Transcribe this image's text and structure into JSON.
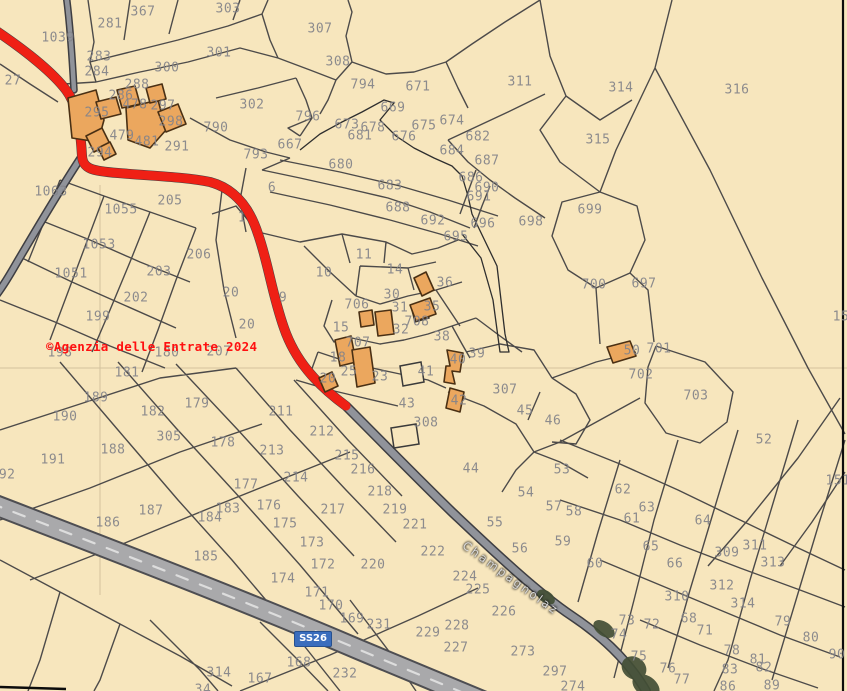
{
  "map": {
    "copyright": "©Agenzia delle Entrate 2024",
    "road_labels": {
      "ss26": "SS26",
      "champagnolaz": "Champagnolaz"
    },
    "colors": {
      "background": "#f7e6bd",
      "parcel_line": "#35353a",
      "building_fill": "#eba75e",
      "building_stroke": "#4a3014",
      "route_highlight_red": "#ef2015",
      "road_fill": "#90939a",
      "highway_fill": "#a9a9ab",
      "ss26_badge_blue": "#3a6dbd",
      "parcel_number_gray": "#84848a",
      "copyright_red": "#ff1010",
      "tree_green": "#434f36"
    },
    "parcels": [
      {
        "n": "1039",
        "x": 58,
        "y": 38
      },
      {
        "n": "281",
        "x": 110,
        "y": 24
      },
      {
        "n": "367",
        "x": 143,
        "y": 12
      },
      {
        "n": "303",
        "x": 228,
        "y": 9
      },
      {
        "n": "307",
        "x": 320,
        "y": 29
      },
      {
        "n": "301",
        "x": 219,
        "y": 53
      },
      {
        "n": "300",
        "x": 167,
        "y": 68
      },
      {
        "n": "283",
        "x": 99,
        "y": 57
      },
      {
        "n": "284",
        "x": 97,
        "y": 72
      },
      {
        "n": "27",
        "x": 13,
        "y": 81
      },
      {
        "n": "288",
        "x": 137,
        "y": 85
      },
      {
        "n": "286",
        "x": 121,
        "y": 96
      },
      {
        "n": "297",
        "x": 163,
        "y": 106
      },
      {
        "n": "478",
        "x": 135,
        "y": 105
      },
      {
        "n": "295",
        "x": 97,
        "y": 113
      },
      {
        "n": "298",
        "x": 171,
        "y": 122
      },
      {
        "n": "302",
        "x": 252,
        "y": 105
      },
      {
        "n": "790",
        "x": 216,
        "y": 128
      },
      {
        "n": "479",
        "x": 122,
        "y": 136
      },
      {
        "n": "481",
        "x": 147,
        "y": 142
      },
      {
        "n": "291",
        "x": 177,
        "y": 147
      },
      {
        "n": "294",
        "x": 100,
        "y": 153
      },
      {
        "n": "793",
        "x": 256,
        "y": 155
      },
      {
        "n": "667",
        "x": 290,
        "y": 145
      },
      {
        "n": "796",
        "x": 308,
        "y": 117
      },
      {
        "n": "669",
        "x": 393,
        "y": 108
      },
      {
        "n": "673",
        "x": 347,
        "y": 125
      },
      {
        "n": "678",
        "x": 373,
        "y": 128
      },
      {
        "n": "675",
        "x": 424,
        "y": 126
      },
      {
        "n": "674",
        "x": 452,
        "y": 121
      },
      {
        "n": "681",
        "x": 360,
        "y": 136
      },
      {
        "n": "676",
        "x": 404,
        "y": 137
      },
      {
        "n": "682",
        "x": 478,
        "y": 137
      },
      {
        "n": "684",
        "x": 452,
        "y": 151
      },
      {
        "n": "687",
        "x": 487,
        "y": 161
      },
      {
        "n": "680",
        "x": 341,
        "y": 165
      },
      {
        "n": "683",
        "x": 390,
        "y": 186
      },
      {
        "n": "686",
        "x": 471,
        "y": 178
      },
      {
        "n": "690",
        "x": 487,
        "y": 188
      },
      {
        "n": "691",
        "x": 479,
        "y": 197
      },
      {
        "n": "688",
        "x": 398,
        "y": 208
      },
      {
        "n": "692",
        "x": 433,
        "y": 221
      },
      {
        "n": "696",
        "x": 483,
        "y": 224
      },
      {
        "n": "698",
        "x": 531,
        "y": 222
      },
      {
        "n": "695",
        "x": 456,
        "y": 237
      },
      {
        "n": "794",
        "x": 363,
        "y": 85
      },
      {
        "n": "671",
        "x": 418,
        "y": 87
      },
      {
        "n": "308",
        "x": 338,
        "y": 62
      },
      {
        "n": "311",
        "x": 520,
        "y": 82
      },
      {
        "n": "314",
        "x": 621,
        "y": 88
      },
      {
        "n": "316",
        "x": 737,
        "y": 90
      },
      {
        "n": "315",
        "x": 598,
        "y": 140
      },
      {
        "n": "699",
        "x": 590,
        "y": 210
      },
      {
        "n": "700",
        "x": 594,
        "y": 285
      },
      {
        "n": "697",
        "x": 644,
        "y": 284
      },
      {
        "n": "1063",
        "x": 51,
        "y": 192
      },
      {
        "n": "205",
        "x": 170,
        "y": 201
      },
      {
        "n": "1055",
        "x": 121,
        "y": 210
      },
      {
        "n": "1053",
        "x": 99,
        "y": 245
      },
      {
        "n": "206",
        "x": 199,
        "y": 255
      },
      {
        "n": "203",
        "x": 159,
        "y": 272
      },
      {
        "n": "1051",
        "x": 71,
        "y": 274
      },
      {
        "n": "202",
        "x": 136,
        "y": 298
      },
      {
        "n": "199",
        "x": 98,
        "y": 317
      },
      {
        "n": "198",
        "x": 60,
        "y": 353
      },
      {
        "n": "180",
        "x": 167,
        "y": 353
      },
      {
        "n": "207",
        "x": 219,
        "y": 352
      },
      {
        "n": "20",
        "x": 231,
        "y": 293
      },
      {
        "n": "20",
        "x": 247,
        "y": 325
      },
      {
        "n": "1",
        "x": 242,
        "y": 218
      },
      {
        "n": "6",
        "x": 272,
        "y": 188
      },
      {
        "n": "9",
        "x": 283,
        "y": 298
      },
      {
        "n": "10",
        "x": 324,
        "y": 273
      },
      {
        "n": "11",
        "x": 364,
        "y": 255
      },
      {
        "n": "14",
        "x": 395,
        "y": 270
      },
      {
        "n": "30",
        "x": 392,
        "y": 295
      },
      {
        "n": "36",
        "x": 445,
        "y": 283
      },
      {
        "n": "706",
        "x": 357,
        "y": 305
      },
      {
        "n": "31",
        "x": 400,
        "y": 308
      },
      {
        "n": "35",
        "x": 432,
        "y": 307
      },
      {
        "n": "708",
        "x": 417,
        "y": 322
      },
      {
        "n": "15",
        "x": 341,
        "y": 328
      },
      {
        "n": "32",
        "x": 401,
        "y": 330
      },
      {
        "n": "38",
        "x": 442,
        "y": 337
      },
      {
        "n": "707",
        "x": 358,
        "y": 343
      },
      {
        "n": "39",
        "x": 477,
        "y": 354
      },
      {
        "n": "40",
        "x": 458,
        "y": 360
      },
      {
        "n": "18",
        "x": 338,
        "y": 358
      },
      {
        "n": "25",
        "x": 349,
        "y": 372
      },
      {
        "n": "23",
        "x": 380,
        "y": 377
      },
      {
        "n": "20",
        "x": 328,
        "y": 379
      },
      {
        "n": "41",
        "x": 426,
        "y": 372
      },
      {
        "n": "43",
        "x": 407,
        "y": 404
      },
      {
        "n": "42",
        "x": 459,
        "y": 401
      },
      {
        "n": "307",
        "x": 505,
        "y": 390
      },
      {
        "n": "308",
        "x": 426,
        "y": 423
      },
      {
        "n": "45",
        "x": 525,
        "y": 411
      },
      {
        "n": "46",
        "x": 553,
        "y": 421
      },
      {
        "n": "44",
        "x": 471,
        "y": 469
      },
      {
        "n": "53",
        "x": 562,
        "y": 470
      },
      {
        "n": "54",
        "x": 526,
        "y": 493
      },
      {
        "n": "55",
        "x": 495,
        "y": 523
      },
      {
        "n": "56",
        "x": 520,
        "y": 549
      },
      {
        "n": "57",
        "x": 554,
        "y": 507
      },
      {
        "n": "58",
        "x": 574,
        "y": 512
      },
      {
        "n": "59",
        "x": 563,
        "y": 542
      },
      {
        "n": "60",
        "x": 595,
        "y": 564
      },
      {
        "n": "62",
        "x": 623,
        "y": 490
      },
      {
        "n": "63",
        "x": 647,
        "y": 508
      },
      {
        "n": "61",
        "x": 632,
        "y": 519
      },
      {
        "n": "64",
        "x": 703,
        "y": 521
      },
      {
        "n": "65",
        "x": 651,
        "y": 547
      },
      {
        "n": "66",
        "x": 675,
        "y": 564
      },
      {
        "n": "52",
        "x": 764,
        "y": 440
      },
      {
        "n": "151",
        "x": 838,
        "y": 481
      },
      {
        "n": "15",
        "x": 841,
        "y": 317
      },
      {
        "n": "309",
        "x": 727,
        "y": 553
      },
      {
        "n": "311",
        "x": 755,
        "y": 546
      },
      {
        "n": "313",
        "x": 773,
        "y": 563
      },
      {
        "n": "312",
        "x": 722,
        "y": 586
      },
      {
        "n": "310",
        "x": 677,
        "y": 597
      },
      {
        "n": "314",
        "x": 743,
        "y": 604
      },
      {
        "n": "68",
        "x": 689,
        "y": 619
      },
      {
        "n": "71",
        "x": 705,
        "y": 631
      },
      {
        "n": "72",
        "x": 652,
        "y": 625
      },
      {
        "n": "73",
        "x": 627,
        "y": 621
      },
      {
        "n": "74",
        "x": 619,
        "y": 635
      },
      {
        "n": "75",
        "x": 639,
        "y": 657
      },
      {
        "n": "76",
        "x": 668,
        "y": 669
      },
      {
        "n": "77",
        "x": 682,
        "y": 680
      },
      {
        "n": "78",
        "x": 732,
        "y": 651
      },
      {
        "n": "79",
        "x": 783,
        "y": 622
      },
      {
        "n": "80",
        "x": 811,
        "y": 638
      },
      {
        "n": "81",
        "x": 758,
        "y": 660
      },
      {
        "n": "82",
        "x": 764,
        "y": 668
      },
      {
        "n": "83",
        "x": 730,
        "y": 670
      },
      {
        "n": "86",
        "x": 728,
        "y": 687
      },
      {
        "n": "89",
        "x": 772,
        "y": 686
      },
      {
        "n": "90",
        "x": 837,
        "y": 655
      },
      {
        "n": "50",
        "x": 632,
        "y": 351
      },
      {
        "n": "701",
        "x": 659,
        "y": 349
      },
      {
        "n": "702",
        "x": 641,
        "y": 375
      },
      {
        "n": "703",
        "x": 696,
        "y": 396
      },
      {
        "n": "211",
        "x": 281,
        "y": 412
      },
      {
        "n": "212",
        "x": 322,
        "y": 432
      },
      {
        "n": "213",
        "x": 272,
        "y": 451
      },
      {
        "n": "214",
        "x": 296,
        "y": 478
      },
      {
        "n": "215",
        "x": 347,
        "y": 456
      },
      {
        "n": "216",
        "x": 363,
        "y": 470
      },
      {
        "n": "217",
        "x": 333,
        "y": 510
      },
      {
        "n": "218",
        "x": 380,
        "y": 492
      },
      {
        "n": "219",
        "x": 395,
        "y": 510
      },
      {
        "n": "220",
        "x": 373,
        "y": 565
      },
      {
        "n": "221",
        "x": 415,
        "y": 525
      },
      {
        "n": "222",
        "x": 433,
        "y": 552
      },
      {
        "n": "224",
        "x": 465,
        "y": 577
      },
      {
        "n": "225",
        "x": 478,
        "y": 590
      },
      {
        "n": "226",
        "x": 504,
        "y": 612
      },
      {
        "n": "227",
        "x": 456,
        "y": 648
      },
      {
        "n": "228",
        "x": 457,
        "y": 626
      },
      {
        "n": "229",
        "x": 428,
        "y": 633
      },
      {
        "n": "231",
        "x": 379,
        "y": 625
      },
      {
        "n": "232",
        "x": 345,
        "y": 674
      },
      {
        "n": "273",
        "x": 523,
        "y": 652
      },
      {
        "n": "297",
        "x": 555,
        "y": 672
      },
      {
        "n": "274",
        "x": 573,
        "y": 687
      },
      {
        "n": "167",
        "x": 260,
        "y": 679
      },
      {
        "n": "168",
        "x": 299,
        "y": 663
      },
      {
        "n": "169",
        "x": 352,
        "y": 619
      },
      {
        "n": "170",
        "x": 331,
        "y": 606
      },
      {
        "n": "171",
        "x": 317,
        "y": 593
      },
      {
        "n": "172",
        "x": 323,
        "y": 565
      },
      {
        "n": "173",
        "x": 312,
        "y": 543
      },
      {
        "n": "174",
        "x": 283,
        "y": 579
      },
      {
        "n": "175",
        "x": 285,
        "y": 524
      },
      {
        "n": "176",
        "x": 269,
        "y": 506
      },
      {
        "n": "177",
        "x": 246,
        "y": 485
      },
      {
        "n": "178",
        "x": 223,
        "y": 443
      },
      {
        "n": "179",
        "x": 197,
        "y": 404
      },
      {
        "n": "181",
        "x": 127,
        "y": 373
      },
      {
        "n": "182",
        "x": 153,
        "y": 412
      },
      {
        "n": "183",
        "x": 228,
        "y": 509
      },
      {
        "n": "184",
        "x": 210,
        "y": 518
      },
      {
        "n": "185",
        "x": 206,
        "y": 557
      },
      {
        "n": "186",
        "x": 108,
        "y": 523
      },
      {
        "n": "187",
        "x": 151,
        "y": 511
      },
      {
        "n": "188",
        "x": 113,
        "y": 450
      },
      {
        "n": "189",
        "x": 96,
        "y": 398
      },
      {
        "n": "190",
        "x": 65,
        "y": 417
      },
      {
        "n": "191",
        "x": 53,
        "y": 460
      },
      {
        "n": "192",
        "x": 3,
        "y": 475
      },
      {
        "n": "305",
        "x": 169,
        "y": 437
      },
      {
        "n": "314",
        "x": 219,
        "y": 673
      },
      {
        "n": "34",
        "x": 203,
        "y": 690
      }
    ]
  }
}
